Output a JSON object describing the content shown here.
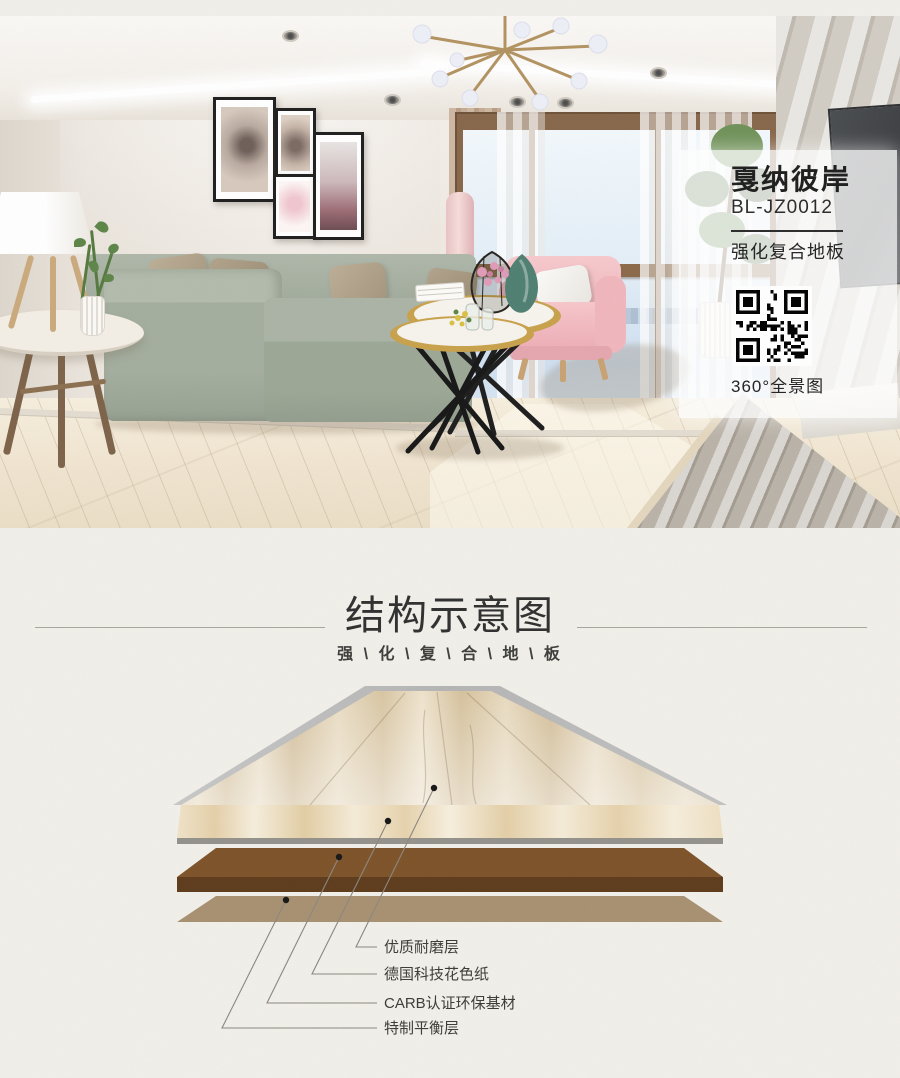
{
  "product": {
    "name": "戛纳彼岸",
    "model": "BL-JZ0012",
    "category": "强化复合地板",
    "qr_caption": "360°全景图"
  },
  "structure_section": {
    "title": "结构示意图",
    "subtitle": "强 \\ 化 \\ 复 \\ 合 \\ 地 \\ 板",
    "layers": [
      {
        "label": "优质耐磨层"
      },
      {
        "label": "德国科技花色纸"
      },
      {
        "label": "CARB认证环保基材"
      },
      {
        "label": "特制平衡层"
      }
    ],
    "layer_colors": {
      "wear": "#bcbcbc",
      "decor_band": "#f2e7d0",
      "substrate": "#7d5228",
      "substrate_front": "#5d3b1b",
      "balance": "#a79070"
    }
  },
  "theme": {
    "page_background": "#f1efe9",
    "panel_background": "#ffffff",
    "text_dark": "#2f2f2f"
  }
}
